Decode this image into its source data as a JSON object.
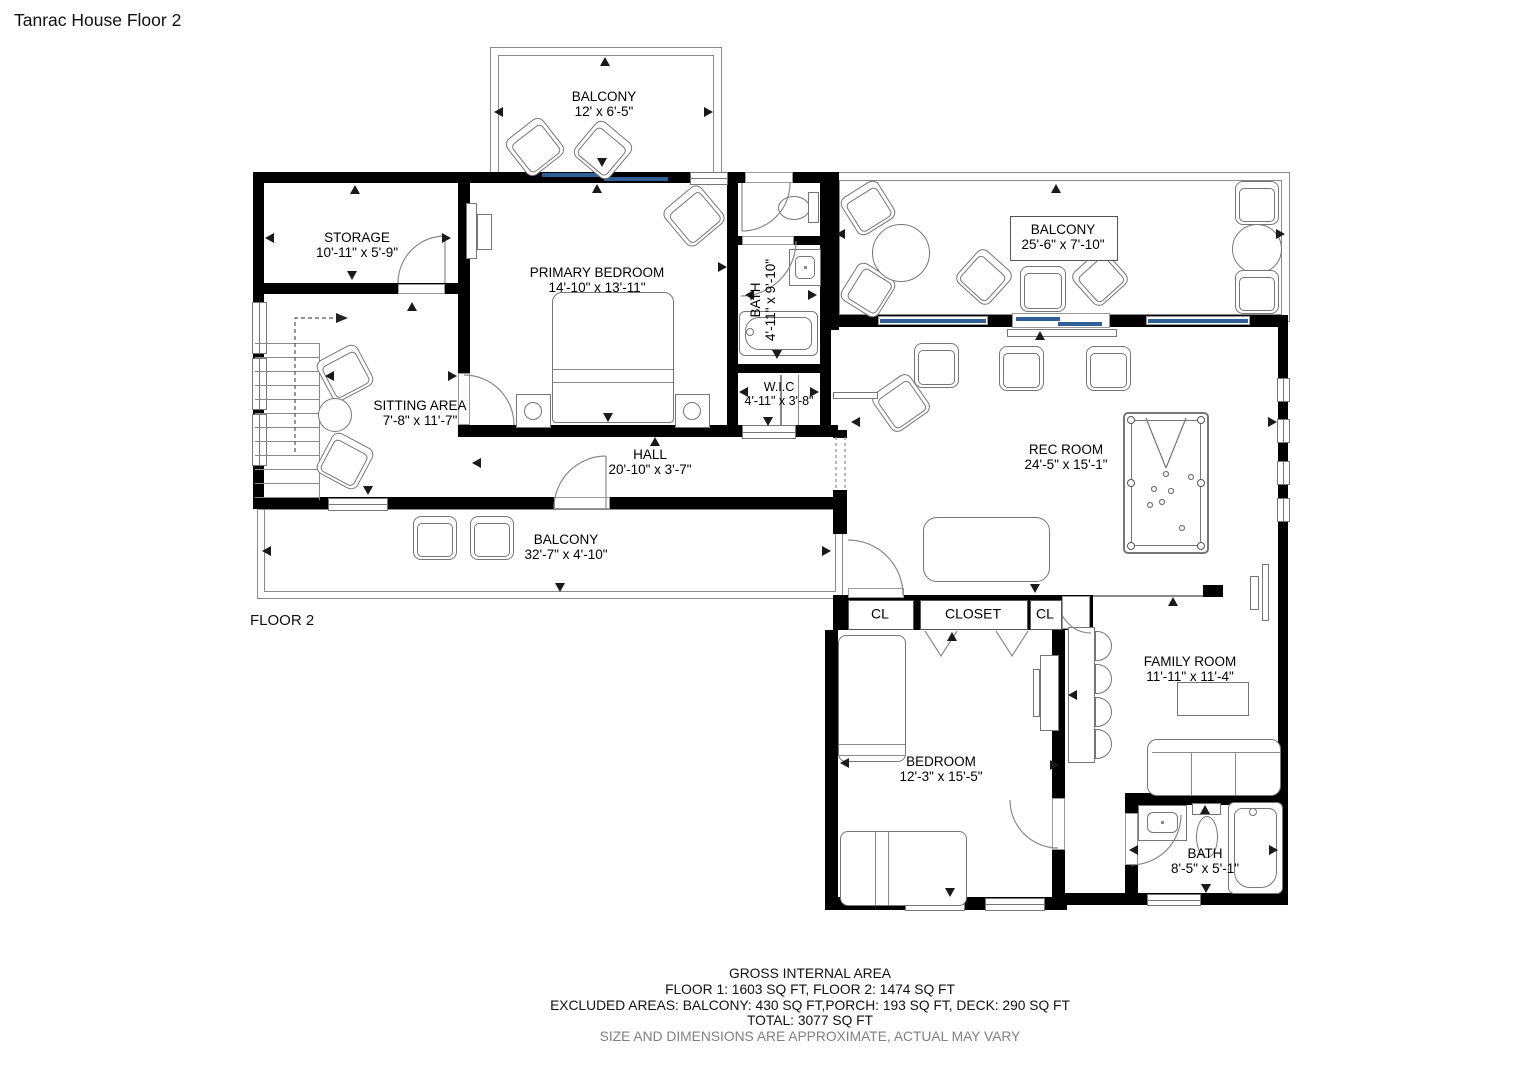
{
  "title": "Tanrac House Floor 2",
  "floor_label": "FLOOR 2",
  "rooms": {
    "balcony_top": {
      "name": "BALCONY",
      "dims": "12' x 6'-5\""
    },
    "storage": {
      "name": "STORAGE",
      "dims": "10'-11\" x 5'-9\""
    },
    "primary_bedroom": {
      "name": "PRIMARY BEDROOM",
      "dims": "14'-10\" x 13'-11\""
    },
    "bath_upper": {
      "name": "BATH",
      "dims": "4'-11\" x 9'-10\""
    },
    "sitting_area": {
      "name": "SITTING AREA",
      "dims": "7'-8\" x 11'-7\""
    },
    "wic": {
      "name": "W.I.C",
      "dims": "4'-11\" x 3'-8\""
    },
    "hall": {
      "name": "HALL",
      "dims": "20'-10\" x 3'-7\""
    },
    "balcony_right": {
      "name": "BALCONY",
      "dims": "25'-6\" x 7'-10\""
    },
    "rec_room": {
      "name": "REC ROOM",
      "dims": "24'-5\" x 15'-1\""
    },
    "balcony_bottom": {
      "name": "BALCONY",
      "dims": "32'-7\" x 4'-10\""
    },
    "closet_left": {
      "label": "CL"
    },
    "closet_center": {
      "label": "CLOSET"
    },
    "closet_right": {
      "label": "CL"
    },
    "family_room": {
      "name": "FAMILY ROOM",
      "dims": "11'-11\" x 11'-4\""
    },
    "bedroom": {
      "name": "BEDROOM",
      "dims": "12'-3\" x 15'-5\""
    },
    "bath_lower": {
      "name": "BATH",
      "dims": "8'-5\" x 5'-1\""
    }
  },
  "footer": {
    "line1": "GROSS INTERNAL AREA",
    "line2": "FLOOR 1: 1603 SQ FT, FLOOR 2: 1474 SQ FT",
    "line3": "EXCLUDED AREAS: BALCONY: 430 SQ FT,PORCH: 193 SQ FT, DECK: 290 SQ FT",
    "line4": "TOTAL: 3077 SQ FT",
    "line5": "SIZE AND DIMENSIONS ARE APPROXIMATE, ACTUAL MAY VARY"
  },
  "colors": {
    "wall": "#000000",
    "window": "#2e5f96",
    "line": "#777777",
    "muted_text": "#808080"
  }
}
